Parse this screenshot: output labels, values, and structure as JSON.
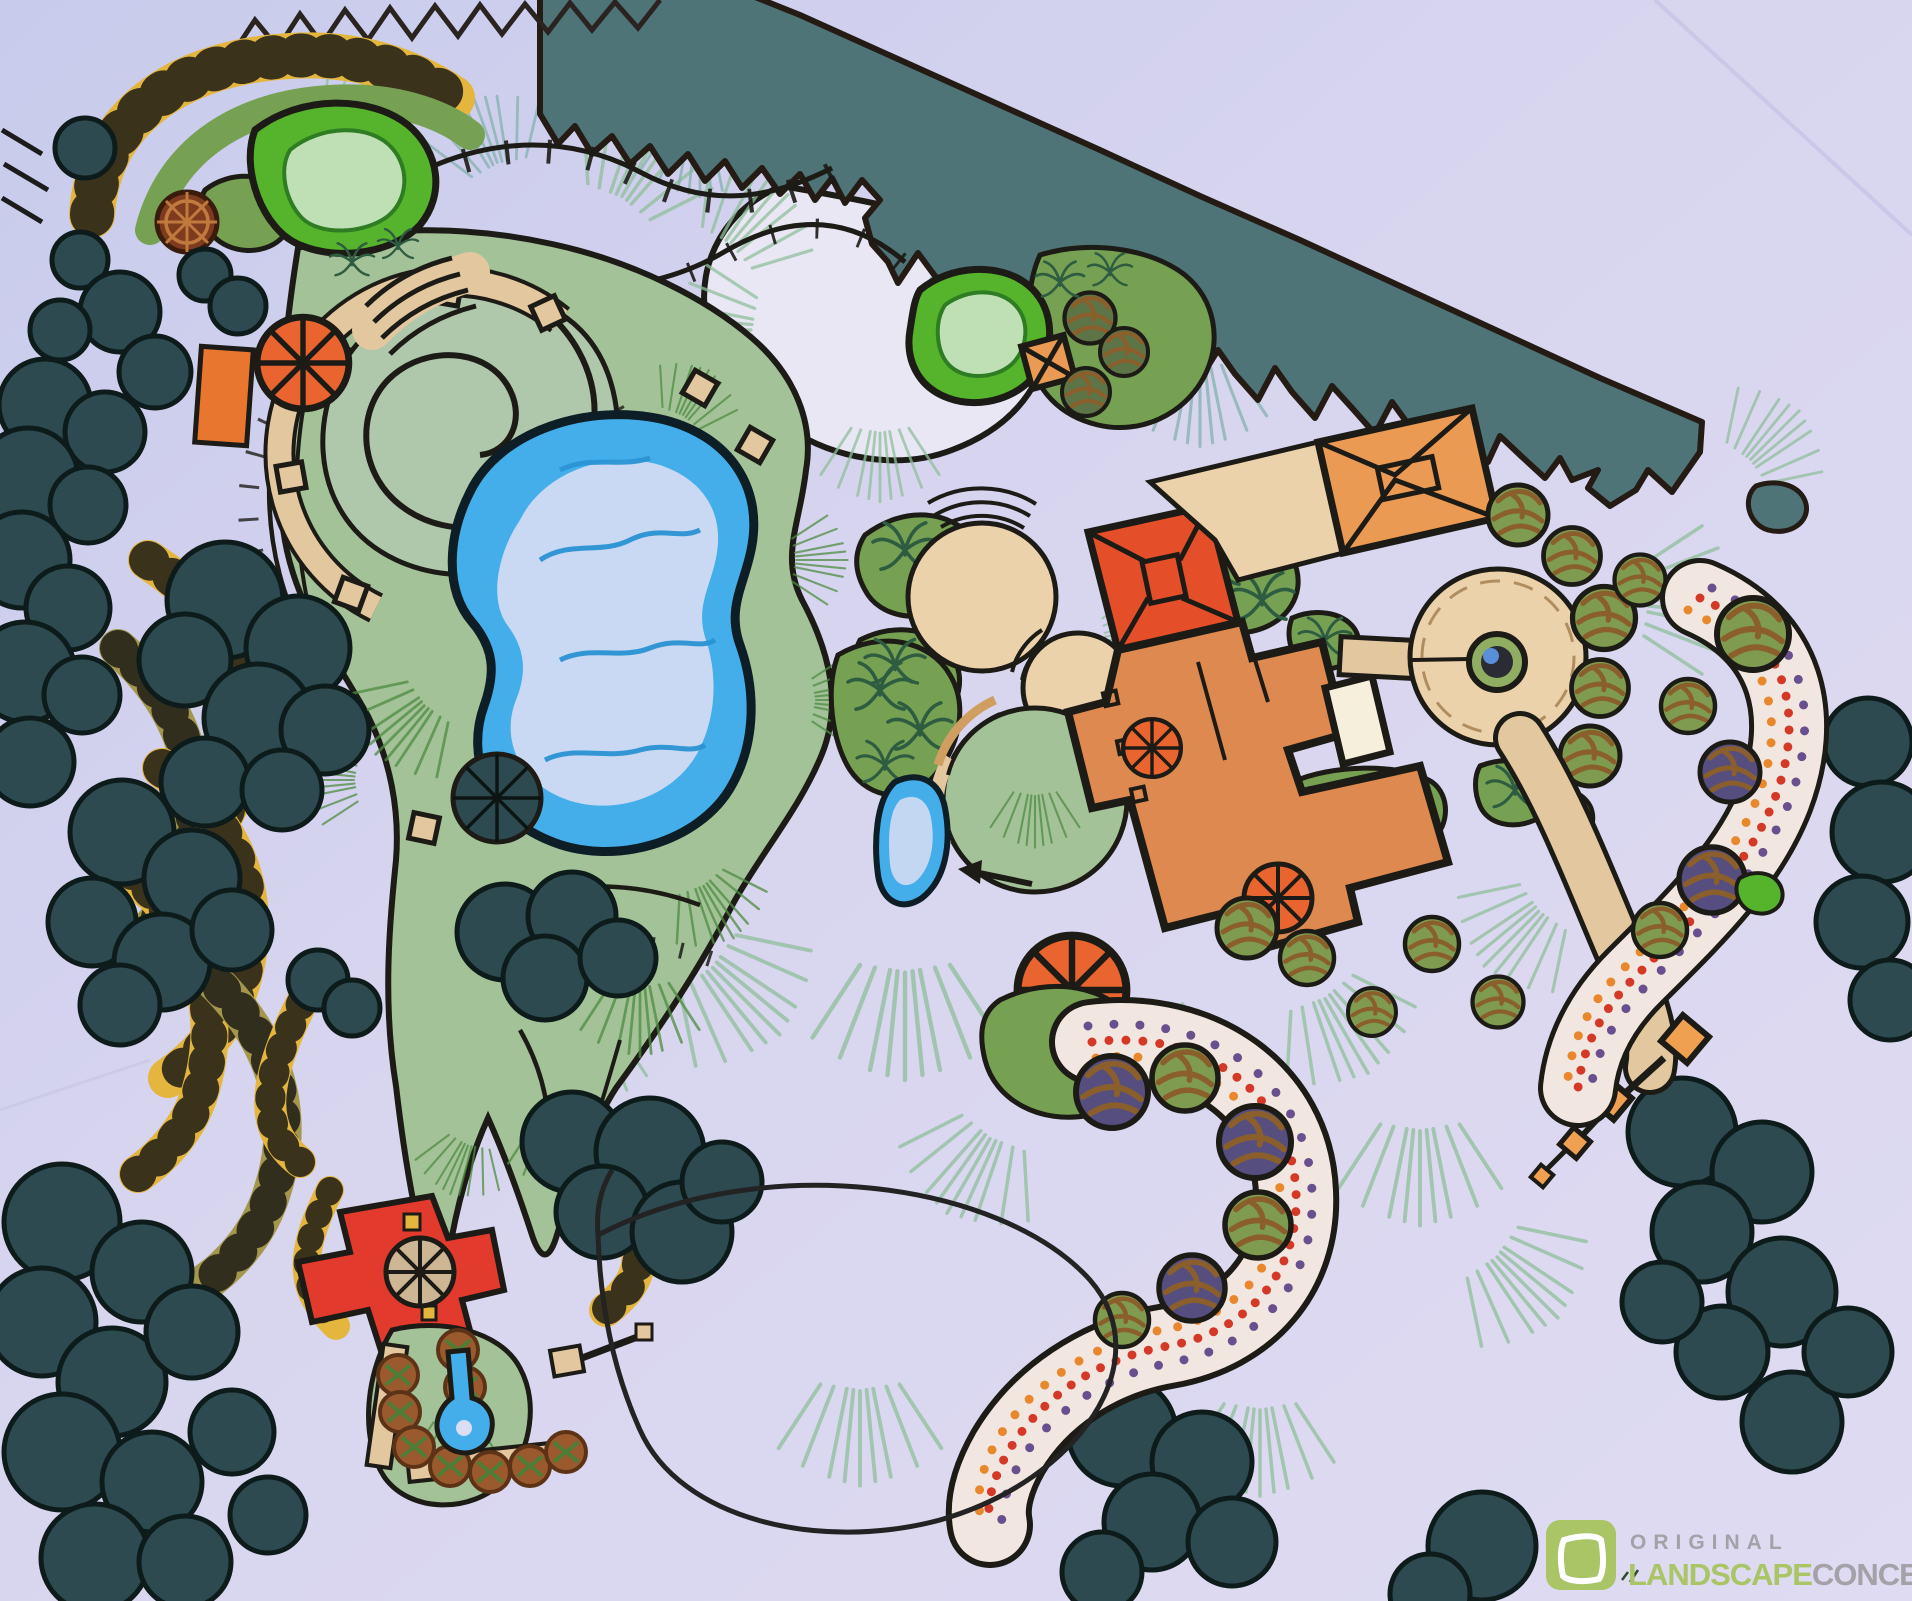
{
  "logo": {
    "brand_top": "ORIGINAL",
    "brand_mid": "LANDSCAPE",
    "brand_suffix": "CONCEPTS"
  },
  "palette": {
    "paper": "#d6d4ee",
    "paperHi": "#e9e7f5",
    "ink": "#1d1b16",
    "treeline": "#4e7477",
    "treeDark": "#2c4a50",
    "lawn": "#a3c298",
    "mound": "#afc7ab",
    "lawnHatch": "#4e8c42",
    "grass1": "#8fbf9b",
    "grass2": "#84b2ae",
    "pond": "#43aee9",
    "pondLight": "#d9def4",
    "pondLine": "#2a93d4",
    "green1": "#56b32c",
    "green1Light": "#bfe0b4",
    "shrub": "#76a152",
    "shrubDark": "#2e5c40",
    "olive": "#7e9b4f",
    "oliveHatch": "#8a5f2b",
    "purpleTree": "#564e7e",
    "house": "#dd8950",
    "roofRed": "#e44e28",
    "roofOrange": "#ea9a52",
    "umbrella": "#e9642e",
    "patio": "#ecd2ab",
    "path": "#e2c79f",
    "step": "#cf9f62",
    "gold": "#e4b63e",
    "gold2": "#a3974b",
    "bedBg": "#f2e7e0",
    "dotRed": "#d43928",
    "dotOrange": "#e8872c",
    "dotPurple": "#6a4f8e",
    "russet": "#9a5a2d",
    "redDeck": "#e23a2c",
    "tanUmbrella": "#cdb694",
    "logoGreen": "#a9c566",
    "logoGray": "#a5a1a8"
  }
}
